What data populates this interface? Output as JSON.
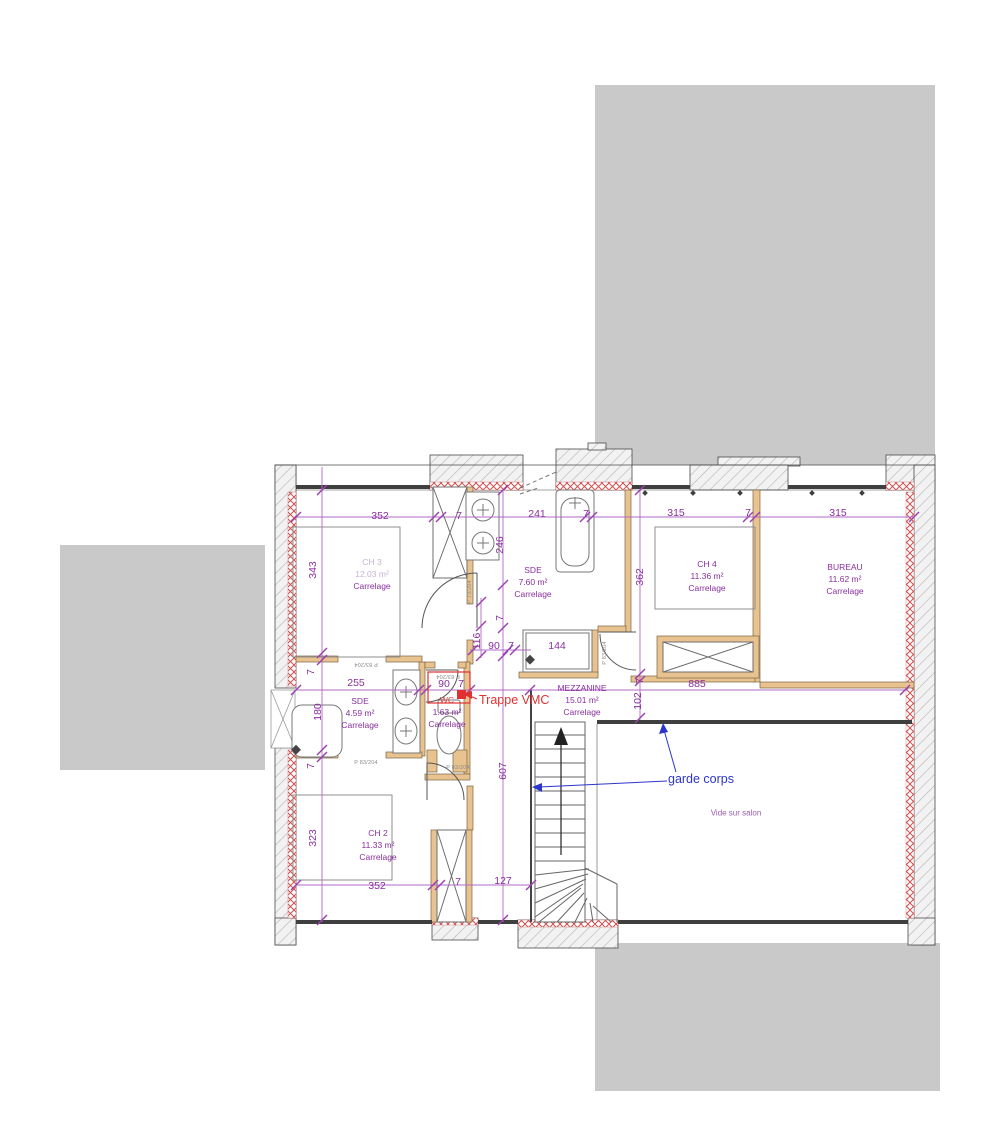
{
  "annotations": {
    "trappe_vmc": "Trappe VMC",
    "garde_corps": "garde corps",
    "vide_sur_salon": "Vide sur salon"
  },
  "rooms": [
    {
      "name": "CH 3",
      "area": "12.03 m²",
      "flooring": "Carrelage",
      "cx": 372,
      "top": 556,
      "faint": true
    },
    {
      "name": "SDE",
      "area": "7.60 m²",
      "flooring": "Carrelage",
      "cx": 533,
      "top": 564
    },
    {
      "name": "CH 4",
      "area": "11.36 m²",
      "flooring": "Carrelage",
      "cx": 707,
      "top": 558
    },
    {
      "name": "BUREAU",
      "area": "11.62 m²",
      "flooring": "Carrelage",
      "cx": 845,
      "top": 561
    },
    {
      "name": "SDE",
      "area": "4.59 m²",
      "flooring": "Carrelage",
      "cx": 360,
      "top": 695
    },
    {
      "name": "WC",
      "area": "1.63 m²",
      "flooring": "Carrelage",
      "cx": 447,
      "top": 694,
      "name_red": true
    },
    {
      "name": "MEZZANINE",
      "area": "15.01 m²",
      "flooring": "Carrelage",
      "cx": 582,
      "top": 682
    },
    {
      "name": "CH 2",
      "area": "11.33 m²",
      "flooring": "Carrelage",
      "cx": 378,
      "top": 827
    }
  ],
  "dimensions": [
    {
      "t": "352",
      "x": 380,
      "y": 516
    },
    {
      "t": "7",
      "x": 459,
      "y": 516
    },
    {
      "t": "241",
      "x": 537,
      "y": 514
    },
    {
      "t": "7",
      "x": 586,
      "y": 514
    },
    {
      "t": "315",
      "x": 676,
      "y": 513
    },
    {
      "t": "7",
      "x": 748,
      "y": 513
    },
    {
      "t": "315",
      "x": 838,
      "y": 513
    },
    {
      "t": "343",
      "x": 313,
      "y": 570,
      "r": 90
    },
    {
      "t": "7",
      "x": 311,
      "y": 672,
      "r": 90
    },
    {
      "t": "255",
      "x": 356,
      "y": 683
    },
    {
      "t": "180",
      "x": 318,
      "y": 712,
      "r": 90
    },
    {
      "t": "7",
      "x": 311,
      "y": 766,
      "r": 90
    },
    {
      "t": "323",
      "x": 313,
      "y": 838,
      "r": 90
    },
    {
      "t": "246",
      "x": 500,
      "y": 545,
      "r": 90
    },
    {
      "t": "7",
      "x": 500,
      "y": 618,
      "r": 90
    },
    {
      "t": "116",
      "x": 477,
      "y": 641,
      "r": 90
    },
    {
      "t": "90",
      "x": 494,
      "y": 646
    },
    {
      "t": "7",
      "x": 511,
      "y": 646
    },
    {
      "t": "90",
      "x": 444,
      "y": 684
    },
    {
      "t": "7",
      "x": 461,
      "y": 684
    },
    {
      "t": "144",
      "x": 557,
      "y": 646
    },
    {
      "t": "607",
      "x": 503,
      "y": 771,
      "r": 90
    },
    {
      "t": "362",
      "x": 640,
      "y": 577,
      "r": 90
    },
    {
      "t": "7",
      "x": 640,
      "y": 681,
      "r": 90
    },
    {
      "t": "102",
      "x": 638,
      "y": 701,
      "r": 90
    },
    {
      "t": "885",
      "x": 697,
      "y": 684
    },
    {
      "t": "352",
      "x": 377,
      "y": 886
    },
    {
      "t": "7",
      "x": 458,
      "y": 882
    },
    {
      "t": "127",
      "x": 503,
      "y": 881
    }
  ],
  "door_labels": [
    {
      "t": "P 83/204",
      "x": 448,
      "y": 676,
      "r": 180
    },
    {
      "t": "P 83/204",
      "x": 366,
      "y": 664,
      "r": 180
    },
    {
      "t": "P 73/204",
      "x": 470,
      "y": 592,
      "r": 90
    },
    {
      "t": "P 83/204",
      "x": 605,
      "y": 653,
      "r": 90
    },
    {
      "t": "P 83/204",
      "x": 458,
      "y": 768,
      "r": 0
    },
    {
      "t": "P 83/204",
      "x": 366,
      "y": 763,
      "r": 0
    }
  ],
  "colors": {
    "dimension_text": "#8a2fa0",
    "dimension_line": "#b268c4",
    "red_annotation": "#e03030",
    "blue_annotation": "#2b35c9",
    "wall_red_hatch": "#d05050",
    "partition_tan": "#e9c38f",
    "roof_mass_gray": "#c9c9c9"
  }
}
